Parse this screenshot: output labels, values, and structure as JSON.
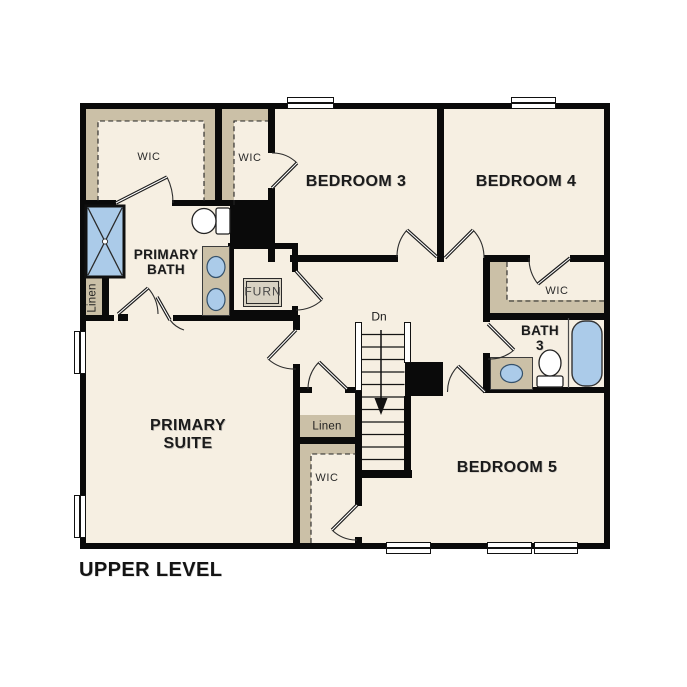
{
  "title": "UPPER LEVEL",
  "rooms": {
    "bedroom3": "BEDROOM 3",
    "bedroom4": "BEDROOM 4",
    "bedroom5": "BEDROOM 5",
    "primary_suite": "PRIMARY SUITE",
    "primary_bath": "PRIMARY BATH",
    "bath3": "BATH 3"
  },
  "closets": {
    "wic_primary": "WIC",
    "wic_bedroom3": "WIC",
    "wic_bedroom4": "WIC",
    "wic_bedroom5": "WIC",
    "linen_bath": "Linen",
    "linen_hall": "Linen",
    "furnace": "FURN"
  },
  "stairs": {
    "direction_label": "Dn"
  },
  "colors": {
    "floor_fill": "#f6efe2",
    "shelf_fill": "#cbc0a7",
    "fixture_blue": "#abcbe9",
    "wall": "#0a0a0a"
  }
}
